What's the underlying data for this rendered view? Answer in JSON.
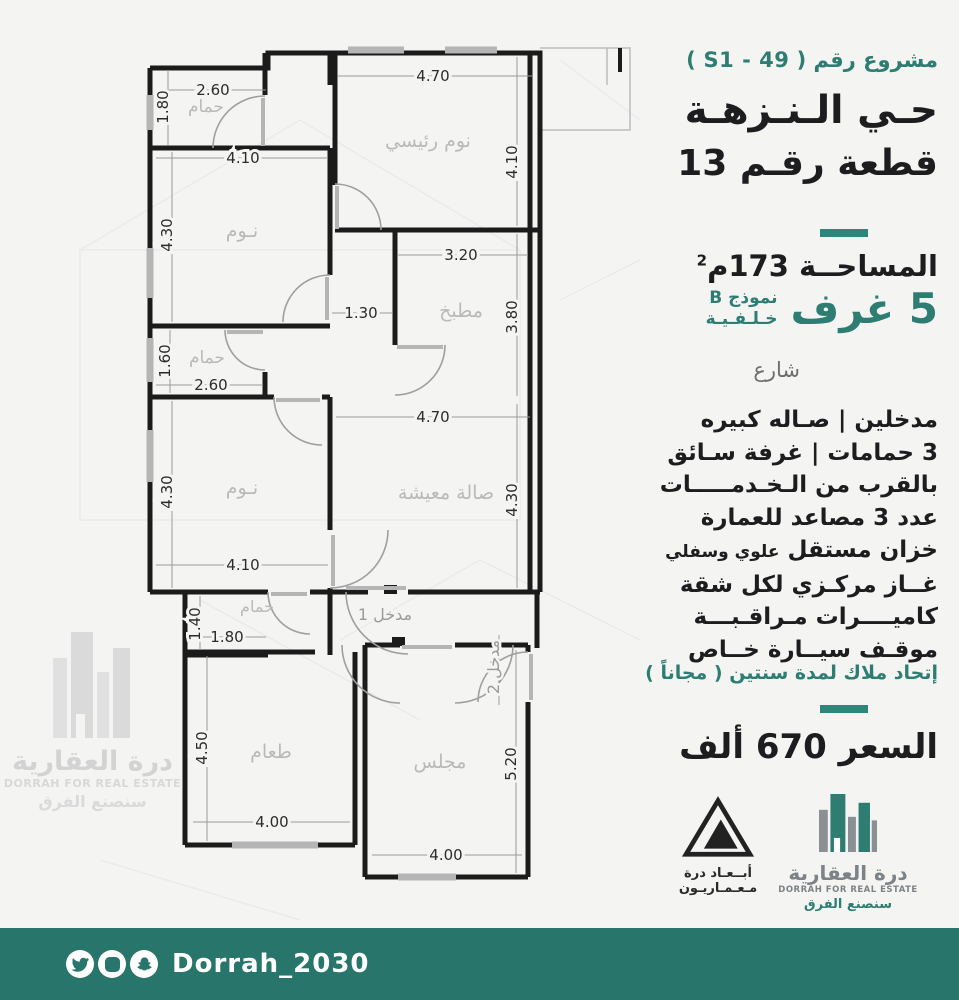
{
  "colors": {
    "accent": "#2e7d72",
    "divider": "#2e8579",
    "footer": "#28766b",
    "walls": "#1b1b1b",
    "muted_label": "#b9b9b9"
  },
  "header": {
    "project_label": "مشروع رقم ( S1 - 49 )",
    "district": "حـي الـنـزهـة",
    "plot": "قطعة رقـم 13"
  },
  "specs": {
    "area_main": "المساحــة 173م",
    "area_sup": "2",
    "rooms_count": "5 غرف",
    "model": "نموذج B",
    "model_sub": "خـلـفـيـة",
    "street": "شارع"
  },
  "features": [
    "مدخلين | صـاله كبيره",
    "3 حمامات | غرفة سـائق",
    "بالقرب من الـخـدمـــــات",
    "عدد 3 مصاعد للعمارة",
    {
      "main": "خزان مستقل",
      "small": "علوي وسفلي"
    },
    "غــاز مركـزي لكل شقة",
    "كاميــــرات مـراقـبـــة",
    "موقـف سيــارة خــاص"
  ],
  "hoa_note": "إتحاد ملاك لمدة سنتين ( مجاناً )",
  "price": "السعر 670 ألف",
  "logos": {
    "architect_line1": "أبــعـاد درة",
    "architect_line2": "مـعـمـاريـون",
    "dorrah_ar": "درة العقارية",
    "dorrah_en": "DORRAH FOR REAL ESTATE",
    "dorrah_slogan": "سنصنع الفرق"
  },
  "footer": {
    "handle": "Dorrah_2030",
    "icons": [
      "twitter-icon",
      "instagram-icon",
      "snapchat-icon"
    ]
  },
  "floorplan": {
    "rooms": [
      {
        "label": "حمام"
      },
      {
        "label": "نوم رئيسي"
      },
      {
        "label": "نـوم"
      },
      {
        "label": "مطبخ"
      },
      {
        "label": "حمام"
      },
      {
        "label": "نـوم"
      },
      {
        "label": "صالة معيشة"
      },
      {
        "label": "حمام"
      },
      {
        "label": "طعام"
      },
      {
        "label": "مجلس"
      }
    ],
    "dims_h": [
      "2.60",
      "4.70",
      "4.10",
      "3.20",
      "1.30",
      "2.60",
      "4.70",
      "4.10",
      "1.80",
      "4.00",
      "4.00"
    ],
    "dims_v": [
      "1.80",
      "4.30",
      "4.10",
      "3.80",
      "1.60",
      "4.30",
      "4.30",
      "1.40",
      "4.50",
      "5.20"
    ],
    "entrance1": "مدخل 1",
    "entrance2": "مدخل 2"
  }
}
